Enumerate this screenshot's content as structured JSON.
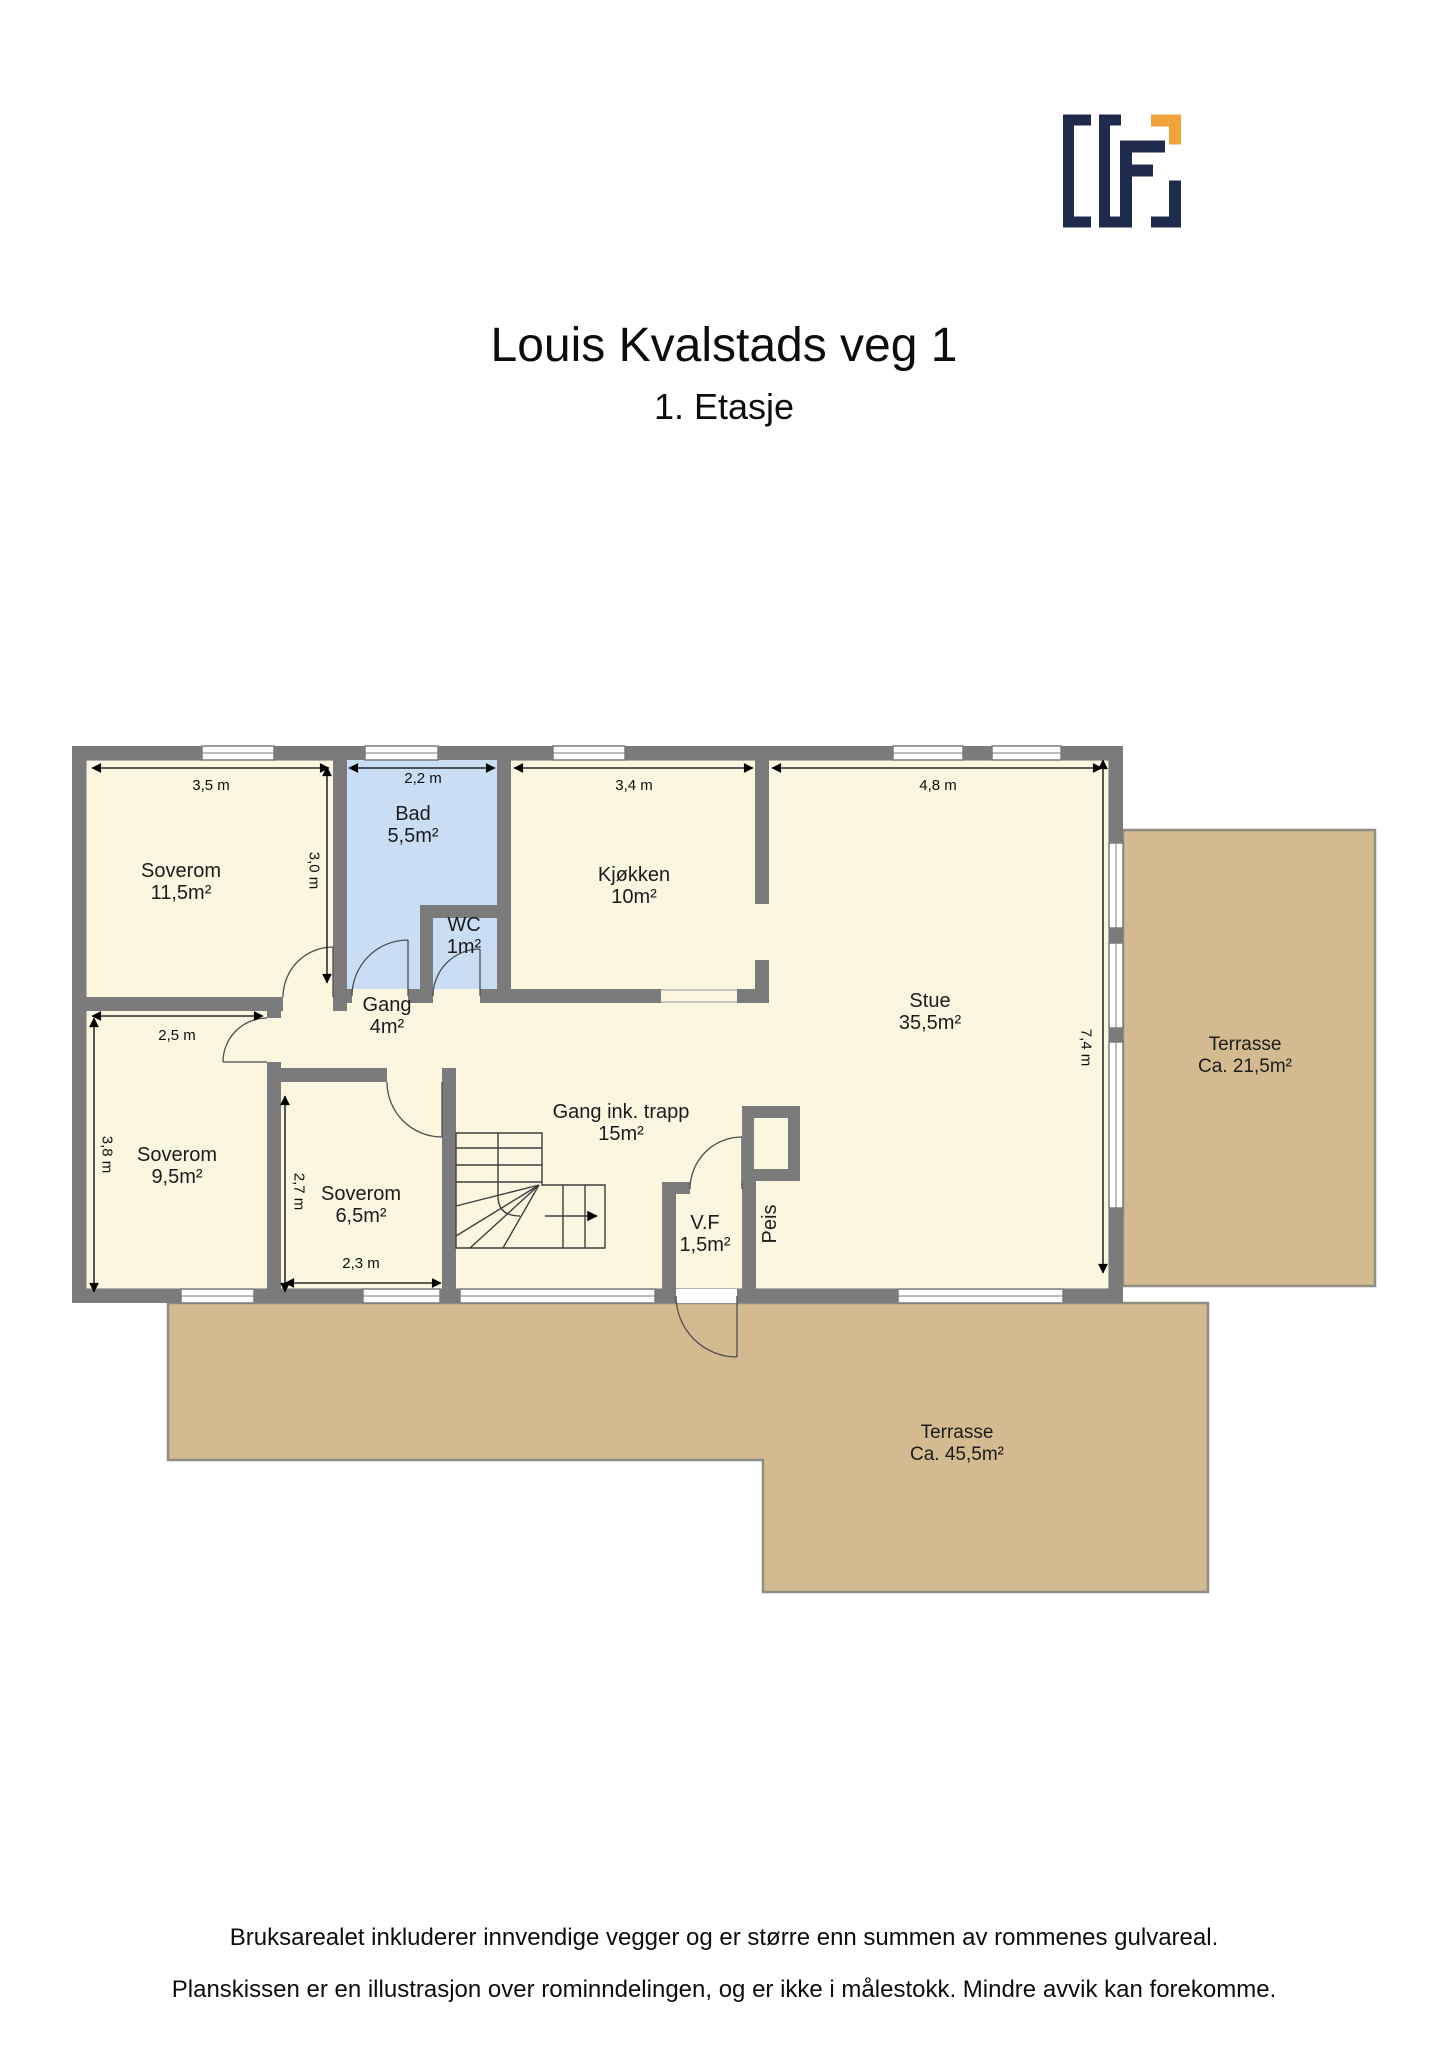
{
  "title": "Louis Kvalstads veg 1",
  "subtitle": "1. Etasje",
  "logo": {
    "line1": "TAKST-",
    "line2": "FORUM",
    "line3": "TRØNDELAG"
  },
  "rooms": {
    "soverom1": {
      "name": "Soverom",
      "area": "11,5m²"
    },
    "bad": {
      "name": "Bad",
      "area": "5,5m²"
    },
    "wc": {
      "name": "WC",
      "area": "1m²"
    },
    "kjokken": {
      "name": "Kjøkken",
      "area": "10m²"
    },
    "stue": {
      "name": "Stue",
      "area": "35,5m²"
    },
    "gang": {
      "name": "Gang",
      "area": "4m²"
    },
    "soverom2": {
      "name": "Soverom",
      "area": "9,5m²"
    },
    "soverom3": {
      "name": "Soverom",
      "area": "6,5m²"
    },
    "gang_trapp": {
      "name": "Gang ink. trapp",
      "area": "15m²"
    },
    "vf": {
      "name": "V.F",
      "area": "1,5m²"
    },
    "peis": {
      "name": "Peis"
    },
    "terrasse_east": {
      "name": "Terrasse",
      "area": "Ca. 21,5m²"
    },
    "terrasse_south": {
      "name": "Terrasse",
      "area": "Ca. 45,5m²"
    }
  },
  "dimensions": {
    "d35": "3,5 m",
    "d22": "2,2 m",
    "d34": "3,4 m",
    "d48": "4,8 m",
    "d30": "3,0 m",
    "d25": "2,5 m",
    "d38": "3,8 m",
    "d27": "2,7 m",
    "d23": "2,3 m",
    "d74": "7,4 m"
  },
  "footer": {
    "line1": "Bruksarealet inkluderer innvendige vegger og er større enn summen av rommenes gulvareal.",
    "line2": "Planskissen er en illustrasjon over rominndelingen, og er ikke i målestokk. Mindre avvik kan forekomme."
  },
  "colors": {
    "wall": "#7b7b7b",
    "room_fill": "#faf6e0",
    "wet_room_fill": "#c9ddf4",
    "terrace_fill": "#d3ba90",
    "terrace_border": "#8f8e83",
    "logo_navy": "#1f2b4d",
    "logo_orange": "#f0a23b"
  }
}
